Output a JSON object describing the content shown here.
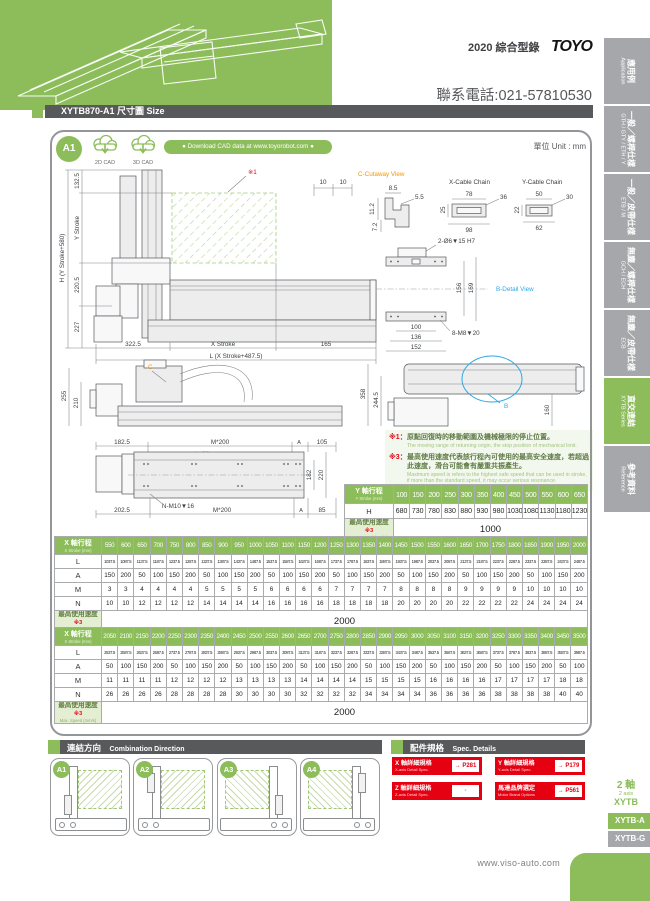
{
  "header": {
    "catalog": "2020 綜合型錄",
    "brand": "TOYO",
    "phone": "聯系電話:021-57810530"
  },
  "sidebar": {
    "tabs": [
      {
        "zh": "應用例",
        "en": "Application"
      },
      {
        "zh": "一般／螺桿仕樣",
        "en": "GTH / GTY / ETH / Y"
      },
      {
        "zh": "一般／皮帶仕樣",
        "en": "ETB / M"
      },
      {
        "zh": "無塵／螺桿仕樣",
        "en": "GCH / ECH"
      },
      {
        "zh": "無塵／皮帶仕樣",
        "en": "ECB"
      },
      {
        "zh": "直交連結",
        "en": "XYTB Series"
      },
      {
        "zh": "參考資料",
        "en": "Reference"
      }
    ],
    "series": {
      "l1": "2 軸",
      "l2": "2 axis",
      "l3": "XYTB"
    },
    "models": [
      {
        "label": "XYTB-A"
      },
      {
        "label": "XYTB-G"
      }
    ]
  },
  "title_bar": {
    "title": "XYTB870-A1 尺寸圖 Size"
  },
  "panel": {
    "badge": "A1",
    "cad2d": "2D CAD",
    "cad3d": "3D CAD",
    "download": "● Download CAD data at www.toyorobot.com ●",
    "unit": "單位 Unit : mm"
  },
  "drawings": {
    "front": {
      "ref": "※1",
      "ten_a": "10",
      "ten_b": "10",
      "d1325": "132.5",
      "ystroke": "Y Stroke",
      "h": "H (Y Stroke+580)",
      "d2205": "220.5",
      "d227": "227",
      "d3225": "322.5",
      "xstroke": "X Stroke",
      "d165": "165",
      "l": "L (X Stroke+487.5)"
    },
    "cutaway": {
      "title": "C-Cutaway View",
      "d85": "8.5",
      "d55": "5.5",
      "d112": "11.2",
      "d72": "7.2"
    },
    "xchain": {
      "title": "X-Cable Chain",
      "d78": "78",
      "d36": "36",
      "d25": "25",
      "d98": "98"
    },
    "ychain": {
      "title": "Y-Cable Chain",
      "d50": "50",
      "d30": "30",
      "d22": "22",
      "d62": "62"
    },
    "bdetail": {
      "title": "B-Detail View",
      "bolts_top": "2-Ø6▼15 H7",
      "d156": "156",
      "d169": "169",
      "d100": "100",
      "d136": "136",
      "d152": "152",
      "bolts_bottom": "8-M8▼20"
    },
    "side": {
      "d255": "255",
      "d210": "210",
      "c": "C"
    },
    "top": {
      "d1825": "182.5",
      "m200a": "M*200",
      "n9": "N-Ø9",
      "a1": "A",
      "d105": "105",
      "d182": "182",
      "d220": "220",
      "d2025": "202.5",
      "nm10": "N-M10▼16",
      "m200b": "M*200",
      "a2": "A",
      "d85": "85"
    },
    "yside": {
      "d358": "358",
      "d2445": "244.5",
      "d160": "160",
      "b": "B"
    }
  },
  "notes": [
    {
      "mark": "※1：",
      "zh": "原點回復時的移動範圍及機械極限的停止位置。",
      "en": "The moving range of returning origin, the stop position of mechanical limit."
    },
    {
      "mark": "※3：",
      "zh": "最高使用速度代表該行程內可使用的最高安全速度，若超過此速度，滑台可能會有嚴重共振產生。",
      "en": "Maximum speed is refers to the highest safe speed that can be used in stroke, if more than the standard speed, it may occur serious resonance."
    }
  ],
  "y_table": {
    "header_zh": "Y 軸行程",
    "header_en": "Y Stroke (mm)",
    "strokes": [
      "100",
      "150",
      "200",
      "250",
      "300",
      "350",
      "400",
      "450",
      "500",
      "550",
      "600",
      "650"
    ],
    "rows": [
      {
        "label": "H",
        "values": [
          "680",
          "730",
          "780",
          "830",
          "880",
          "930",
          "980",
          "1030",
          "1080",
          "1130",
          "1180",
          "1230"
        ]
      }
    ],
    "speed": {
      "zh": "最高使用速度",
      "mark": "※3",
      "en": "Max. Speed (mm/s)",
      "value": "1000"
    }
  },
  "x_table_1": {
    "header_zh": "X 軸行程",
    "header_en": "X Stroke (mm)",
    "strokes": [
      "550",
      "600",
      "650",
      "700",
      "750",
      "800",
      "850",
      "900",
      "950",
      "1000",
      "1050",
      "1100",
      "1150",
      "1200",
      "1250",
      "1300",
      "1350",
      "1400",
      "1450",
      "1500",
      "1550",
      "1600",
      "1650",
      "1700",
      "1750",
      "1800",
      "1850",
      "1900",
      "1950",
      "2000"
    ],
    "rows": [
      {
        "label": "L",
        "small": true,
        "values": [
          "1037.5",
          "1087.5",
          "1137.5",
          "1187.5",
          "1237.5",
          "1287.5",
          "1337.5",
          "1387.5",
          "1437.5",
          "1487.5",
          "1537.5",
          "1587.5",
          "1637.5",
          "1687.5",
          "1737.5",
          "1787.5",
          "1837.5",
          "1887.5",
          "1937.5",
          "1987.5",
          "2037.5",
          "2087.5",
          "2137.5",
          "2187.5",
          "2237.5",
          "2287.5",
          "2337.5",
          "2387.5",
          "2437.5",
          "2487.5"
        ]
      },
      {
        "label": "A",
        "values": [
          "150",
          "200",
          "50",
          "100",
          "150",
          "200",
          "50",
          "100",
          "150",
          "200",
          "50",
          "100",
          "150",
          "200",
          "50",
          "100",
          "150",
          "200",
          "50",
          "100",
          "150",
          "200",
          "50",
          "100",
          "150",
          "200",
          "50",
          "100",
          "150",
          "200"
        ]
      },
      {
        "label": "M",
        "values": [
          "3",
          "3",
          "4",
          "4",
          "4",
          "4",
          "5",
          "5",
          "5",
          "5",
          "6",
          "6",
          "6",
          "6",
          "7",
          "7",
          "7",
          "7",
          "8",
          "8",
          "8",
          "8",
          "9",
          "9",
          "9",
          "9",
          "10",
          "10",
          "10",
          "10"
        ]
      },
      {
        "label": "N",
        "values": [
          "10",
          "10",
          "12",
          "12",
          "12",
          "12",
          "14",
          "14",
          "14",
          "14",
          "16",
          "16",
          "16",
          "16",
          "18",
          "18",
          "18",
          "18",
          "20",
          "20",
          "20",
          "20",
          "22",
          "22",
          "22",
          "22",
          "24",
          "24",
          "24",
          "24"
        ]
      }
    ],
    "speed": {
      "zh": "最高使用速度",
      "mark": "※3",
      "en": "Max. Speed (mm/s)",
      "value": "2000"
    }
  },
  "x_table_2": {
    "header_zh": "X 軸行程",
    "header_en": "X Stroke (mm)",
    "strokes": [
      "2050",
      "2100",
      "2150",
      "2200",
      "2250",
      "2300",
      "2350",
      "2400",
      "2450",
      "2500",
      "2550",
      "2600",
      "2650",
      "2700",
      "2750",
      "2800",
      "2850",
      "2900",
      "2950",
      "3000",
      "3050",
      "3100",
      "3150",
      "3200",
      "3250",
      "3300",
      "3350",
      "3400",
      "3450",
      "3500"
    ],
    "rows": [
      {
        "label": "L",
        "small": true,
        "values": [
          "2537.5",
          "2587.5",
          "2637.5",
          "2687.5",
          "2737.5",
          "2787.5",
          "2837.5",
          "2887.5",
          "2937.5",
          "2987.5",
          "3037.5",
          "3087.5",
          "3137.5",
          "3187.5",
          "3237.5",
          "3287.5",
          "3337.5",
          "3387.5",
          "3437.5",
          "3487.5",
          "3537.5",
          "3587.5",
          "3637.5",
          "3687.5",
          "3737.5",
          "3787.5",
          "3837.5",
          "3887.5",
          "3937.5",
          "3987.5"
        ]
      },
      {
        "label": "A",
        "values": [
          "50",
          "100",
          "150",
          "200",
          "50",
          "100",
          "150",
          "200",
          "50",
          "100",
          "150",
          "200",
          "50",
          "100",
          "150",
          "200",
          "50",
          "100",
          "150",
          "200",
          "50",
          "100",
          "150",
          "200",
          "50",
          "100",
          "150",
          "200",
          "50",
          "100"
        ]
      },
      {
        "label": "M",
        "values": [
          "11",
          "11",
          "11",
          "11",
          "12",
          "12",
          "12",
          "12",
          "13",
          "13",
          "13",
          "13",
          "14",
          "14",
          "14",
          "14",
          "15",
          "15",
          "15",
          "15",
          "16",
          "16",
          "16",
          "16",
          "17",
          "17",
          "17",
          "17",
          "18",
          "18"
        ]
      },
      {
        "label": "N",
        "values": [
          "26",
          "26",
          "26",
          "26",
          "28",
          "28",
          "28",
          "28",
          "30",
          "30",
          "30",
          "30",
          "32",
          "32",
          "32",
          "32",
          "34",
          "34",
          "34",
          "34",
          "36",
          "36",
          "36",
          "36",
          "38",
          "38",
          "38",
          "38",
          "40",
          "40"
        ]
      }
    ],
    "speed": {
      "zh": "最高使用速度",
      "mark": "※3",
      "en": "Max. Speed (mm/s)",
      "value": "2000"
    }
  },
  "combination": {
    "zh": "連結方向",
    "en": "Combination Direction",
    "cards": [
      "A1",
      "A2",
      "A3",
      "A4"
    ]
  },
  "spec": {
    "zh": "配件規格",
    "en": "Spec. Details",
    "buttons": [
      {
        "zh": "X 軸詳細規格",
        "en": "X-axis Detail Spec.",
        "page": "→ P281"
      },
      {
        "zh": "Y 軸詳細規格",
        "en": "Y-axis Detail Spec.",
        "page": "→ P179"
      },
      {
        "zh": "Z 軸詳細規格",
        "en": "Z-axis Detail Spec.",
        "page": "-"
      },
      {
        "zh": "馬達品牌選定",
        "en": "Motor Brand Options",
        "page": "→ P561"
      }
    ]
  },
  "footer": {
    "site": "www.viso-auto.com"
  }
}
